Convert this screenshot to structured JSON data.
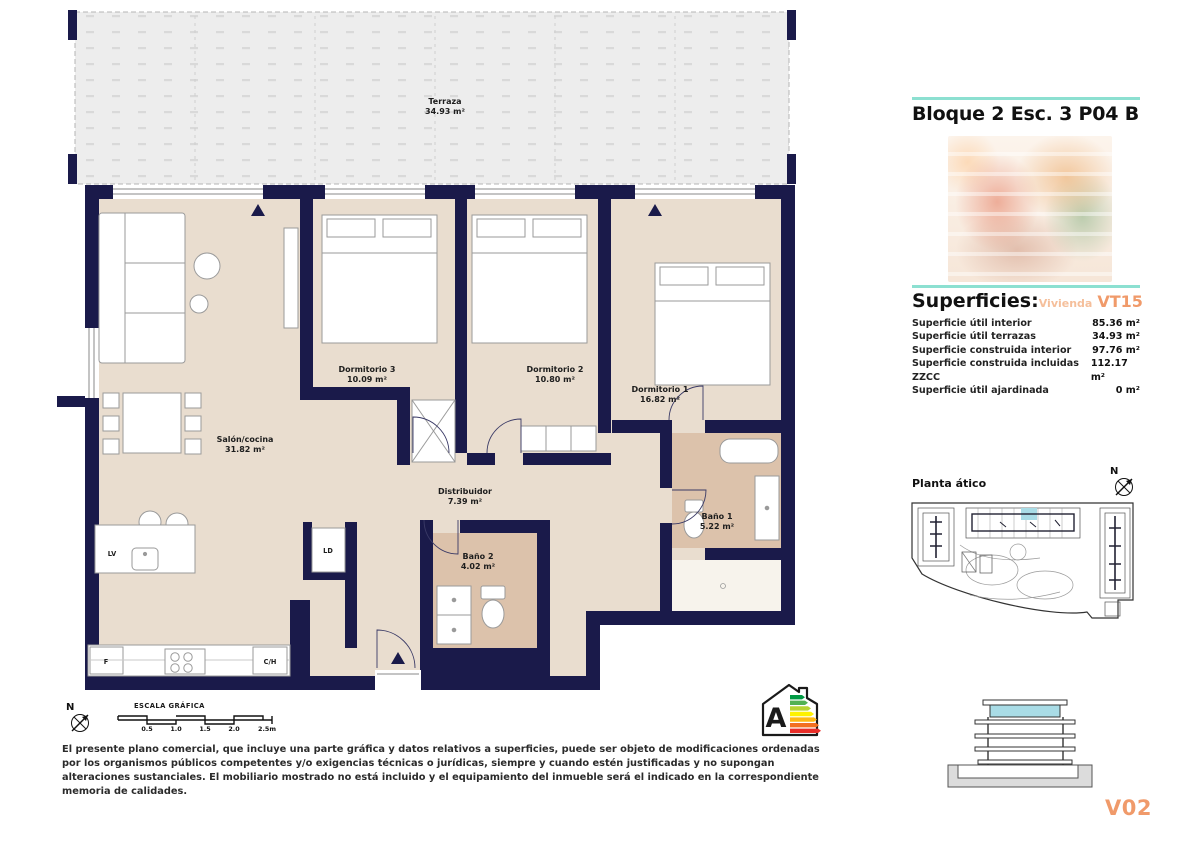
{
  "plan": {
    "terraza": {
      "name": "Terraza",
      "area": "34.93 m²"
    },
    "rooms": [
      {
        "name": "Salón/cocina",
        "area": "31.82 m²"
      },
      {
        "name": "Dormitorio 3",
        "area": "10.09 m²"
      },
      {
        "name": "Dormitorio 2",
        "area": "10.80 m²"
      },
      {
        "name": "Dormitorio 1",
        "area": "16.82 m²"
      },
      {
        "name": "Distribuidor",
        "area": "7.39 m²"
      },
      {
        "name": "Baño 1",
        "area": "5.22 m²"
      },
      {
        "name": "Baño 2",
        "area": "4.02 m²"
      }
    ],
    "appliances": {
      "lv": "LV",
      "ld": "LD",
      "f": "F",
      "ch": "C/H"
    },
    "scale": {
      "title": "ESCALA GRÁFICA",
      "ticks": [
        "0.5",
        "1.0",
        "1.5",
        "2.0",
        "2.5m"
      ]
    },
    "north_letter": "N",
    "energy_rating": "A"
  },
  "sidebar": {
    "title": "Bloque 2 Esc. 3 P04 B",
    "superficies": {
      "heading": "Superficies:",
      "vivienda_label": "Vivienda",
      "vivienda_code": "VT15",
      "rows": [
        {
          "label": "Superficie útil interior",
          "value": "85.36 m²"
        },
        {
          "label": "Superficie útil terrazas",
          "value": "34.93 m²"
        },
        {
          "label": "Superficie construida interior",
          "value": "97.76 m²"
        },
        {
          "label": "Superficie construida incluidas ZZCC",
          "value": "112.17 m²"
        },
        {
          "label": "Superficie útil ajardinada",
          "value": "0 m²"
        }
      ]
    },
    "site_plan_label": "Planta ático",
    "version": "V02"
  },
  "footer": {
    "disclaimer": "El presente plano comercial, que incluye una parte gráfica y datos relativos a superficies, puede ser objeto de modificaciones ordenadas por los organismos públicos competentes y/o exigencias técnicas o jurídicas, siempre y cuando estén justificadas y no supongan alteraciones sustanciales. El mobiliario mostrado no está incluido y el equipamiento del inmueble será el indicado en la correspondiente memoria de calidades."
  },
  "icons": {
    "north_compass": "compass-icon",
    "energy_label": "energy-rating-house-icon"
  },
  "colors": {
    "wall_navy": "#1a1a4a",
    "floor_beige": "#e9ddcf",
    "bath_tan": "#dcc2ab",
    "terrace_grey": "#ededed",
    "accent_teal": "#8ce0d1",
    "accent_orange": "#f09a6a",
    "highlight_cyan": "#a9dce6",
    "energy_bars": [
      "#009a44",
      "#52b153",
      "#b8d433",
      "#fef200",
      "#fdb814",
      "#f36f21",
      "#e92e29"
    ]
  }
}
